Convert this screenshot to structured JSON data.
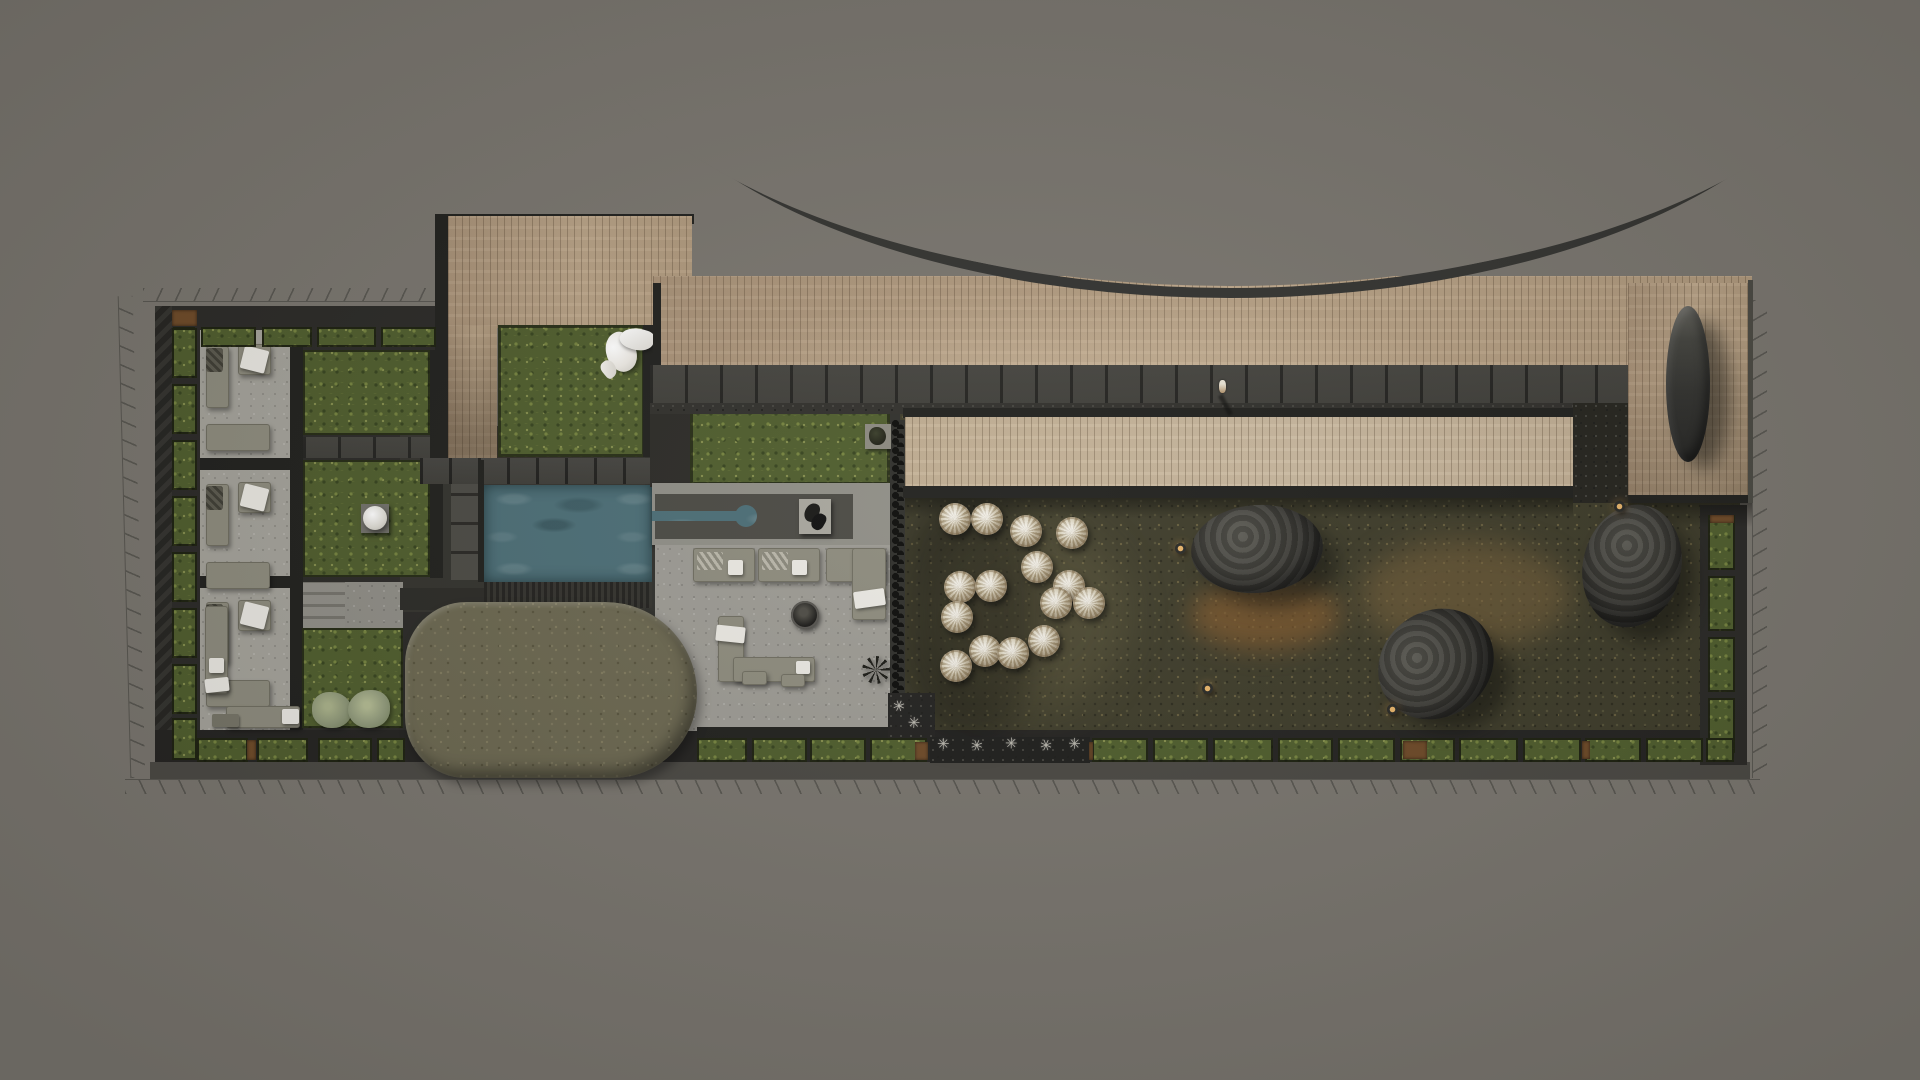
{
  "meta": {
    "title": "rooftop-landscape-masterplan-render",
    "canvas": {
      "width": 1920,
      "height": 1080
    },
    "background_color": "#79756e"
  },
  "palette": {
    "charcoal": "#262522",
    "wall_dark": "#2e2d29",
    "wood_deck": "#b49d80",
    "wood_walkway": "#c6b398",
    "hedge_green": "#55632f",
    "moss_garden": "#3e3c2a",
    "lawn_green": "#6b6750",
    "pool_water": "#4c6e76",
    "concrete_patio": "#9c9a93",
    "pouf_cream": "#d8d0ba",
    "boulder_gray": "#373631",
    "soil_brown": "#6e4a28",
    "bollard_amber": "#e8b46a",
    "stencil_white": "#d6d3c8",
    "property_line": "#53514b"
  },
  "collections": {
    "rooms": {
      "left": 200,
      "width": 100,
      "tops": [
        332,
        470,
        588
      ],
      "note": "suite-lounge-rooms-with-l-sofas"
    },
    "hedge_boxes_top": {
      "y": 327,
      "h": 20,
      "xw": [
        [
          173,
          22
        ],
        [
          201,
          55
        ],
        [
          262,
          50
        ],
        [
          317,
          59
        ],
        [
          381,
          55
        ]
      ]
    },
    "hedge_boxes_left": {
      "x": 172,
      "w": 25,
      "yh": [
        [
          328,
          50
        ],
        [
          384,
          50
        ],
        [
          440,
          50
        ],
        [
          496,
          50
        ],
        [
          552,
          50
        ],
        [
          608,
          50
        ],
        [
          664,
          50
        ],
        [
          718,
          42
        ]
      ]
    },
    "hedge_boxes_right": {
      "x": 1708,
      "w": 27,
      "yh": [
        [
          515,
          55
        ],
        [
          576,
          55
        ],
        [
          637,
          55
        ],
        [
          698,
          55
        ]
      ]
    },
    "hedge_boxes_bottom": {
      "y": 738,
      "h": 24,
      "xw": [
        [
          197,
          51
        ],
        [
          257,
          51
        ],
        [
          318,
          54
        ],
        [
          377,
          28
        ],
        [
          697,
          50
        ],
        [
          752,
          55
        ],
        [
          810,
          56
        ],
        [
          870,
          57
        ],
        [
          1092,
          56
        ],
        [
          1153,
          55
        ],
        [
          1213,
          60
        ],
        [
          1278,
          55
        ],
        [
          1338,
          57
        ],
        [
          1400,
          55
        ],
        [
          1459,
          59
        ],
        [
          1523,
          58
        ],
        [
          1585,
          56
        ],
        [
          1646,
          57
        ],
        [
          1706,
          28
        ]
      ]
    },
    "soil_pots": [
      [
        172,
        310,
        25,
        16
      ],
      [
        247,
        740,
        9,
        20
      ],
      [
        915,
        742,
        13,
        18
      ],
      [
        1089,
        742,
        4,
        18
      ],
      [
        1403,
        741,
        24,
        18
      ],
      [
        1582,
        741,
        8,
        18
      ],
      [
        1710,
        515,
        24,
        8
      ]
    ],
    "poufs": {
      "radius": 16,
      "centers": [
        [
          955,
          519
        ],
        [
          987,
          519
        ],
        [
          1026,
          531
        ],
        [
          1072,
          533
        ],
        [
          1037,
          567
        ],
        [
          960,
          587
        ],
        [
          991,
          586
        ],
        [
          1069,
          586
        ],
        [
          1056,
          603
        ],
        [
          1089,
          603
        ],
        [
          957,
          617
        ],
        [
          1044,
          641
        ],
        [
          985,
          651
        ],
        [
          1013,
          653
        ],
        [
          956,
          666
        ]
      ]
    },
    "boulders": [
      {
        "cx": 1257,
        "cy": 549,
        "rx": 66,
        "ry": 44,
        "rot": -4
      },
      {
        "cx": 1436,
        "cy": 664,
        "rx": 60,
        "ry": 53,
        "rot": -35
      },
      {
        "cx": 1632,
        "cy": 566,
        "rx": 49,
        "ry": 62,
        "rot": 14
      }
    ],
    "bollard_lights": [
      [
        1180,
        548
      ],
      [
        1207,
        688
      ],
      [
        1392,
        709
      ],
      [
        1619,
        506
      ]
    ],
    "stencil_glyph": "✳",
    "stencil_positions": [
      [
        944,
        744
      ],
      [
        977,
        746
      ],
      [
        1011,
        744
      ],
      [
        1045,
        746
      ],
      [
        1073,
        744
      ],
      [
        897,
        706
      ],
      [
        912,
        722
      ]
    ],
    "human_figure": {
      "x": 1221,
      "y": 384
    }
  }
}
